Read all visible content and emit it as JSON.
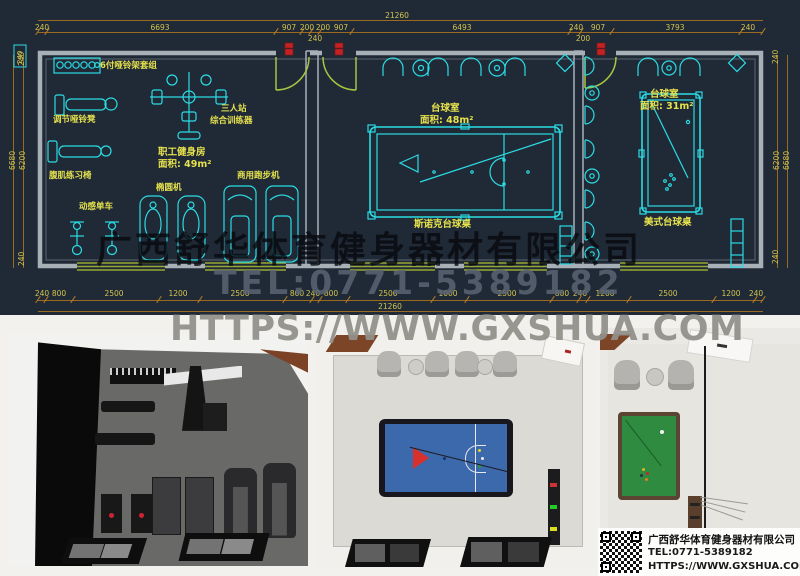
{
  "watermark": {
    "company": "广西舒华体育健身器材有限公司",
    "tel": "TEL:0771-5389182",
    "url": "HTTPS://WWW.GXSHUA.COM"
  },
  "info_panel": {
    "company": "广西舒华体育健身器材有限公司",
    "tel": "TEL:0771-5389182",
    "url": "HTTPS://WWW.GXSHUA.COM"
  },
  "cad": {
    "colors": {
      "background": "#202a37",
      "cyan_line": "#2bdce4",
      "dim_text": "#d2c44e",
      "label_yellow": "#e6e24e",
      "wall_gray": "#a7afb7",
      "door_arc_green": "#a8c63e",
      "window_green": "#97a832",
      "marker_red": "#c42222"
    },
    "dims": {
      "total_top": "21260",
      "total_bottom": "21260",
      "top": [
        "240",
        "6693",
        "907",
        "200",
        "200",
        "907",
        "6493",
        "240",
        "907",
        "3793",
        "240"
      ],
      "top_sub": [
        "240",
        "200"
      ],
      "bottom": [
        "240",
        "800",
        "2500",
        "1200",
        "2500",
        "800",
        "240",
        "800",
        "2500",
        "1000",
        "2500",
        "800",
        "240",
        "1200",
        "2500",
        "1200",
        "240"
      ],
      "left": [
        "240",
        "6680",
        "6200",
        "240"
      ],
      "right": [
        "240",
        "6200",
        "6680",
        "240"
      ],
      "wall_box": "240"
    },
    "gym": {
      "title": "职工健身房",
      "area": "面积: 49m²",
      "labels": {
        "dumbbell_rack": "6付哑铃架套组",
        "bench": "调节哑铃凳",
        "trainer_line1": "三人站",
        "trainer_line2": "综合训练器",
        "treadmill": "商用跑步机",
        "elliptical": "椭圆机",
        "ab_chair": "腹肌练习椅",
        "spin_bike": "动感单车"
      }
    },
    "snooker": {
      "title": "台球室",
      "area": "面积: 48m²",
      "table": "斯诺克台球桌"
    },
    "pool": {
      "title": "台球室",
      "area": "面积: 31m²",
      "table": "美式台球桌"
    }
  }
}
